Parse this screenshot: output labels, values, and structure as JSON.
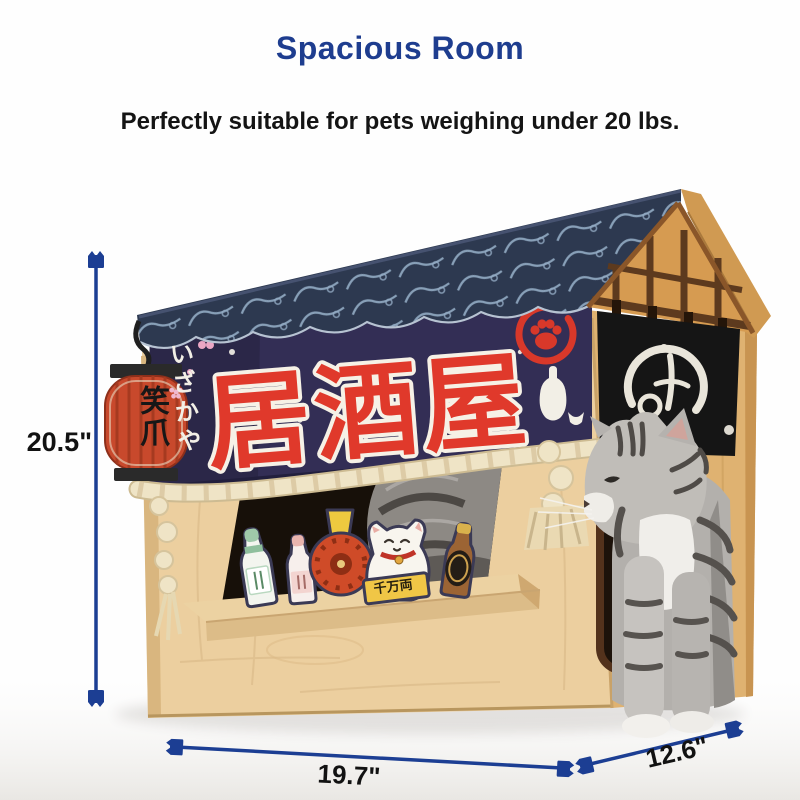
{
  "header": {
    "title": "Spacious Room",
    "subtitle": "Perfectly suitable for pets weighing under 20 lbs."
  },
  "dimensions": {
    "height": "20.5\"",
    "width": "19.7\"",
    "depth": "12.6\""
  },
  "house": {
    "noren_banner_text": "居酒屋",
    "kana_text": "いざかや",
    "lantern_text": "笑爪",
    "maneki_banner_text": "千万両"
  },
  "colors": {
    "accent_blue": "#1e3d8f",
    "dimension_blue": "#1c3e93",
    "banner_navy": "#332e55",
    "roof_navy": "#2d3950",
    "brand_red": "#e0392b",
    "wood_tan": "#eccf9f",
    "rope_cream": "#efe4c6",
    "label_black": "#141414"
  },
  "icons": {
    "dimension_marker": "cat-head",
    "banner_badge": "paw-print-in-brush-circle",
    "banner_motifs": "sakura-blossom, sake-bottle, snow-dots"
  }
}
